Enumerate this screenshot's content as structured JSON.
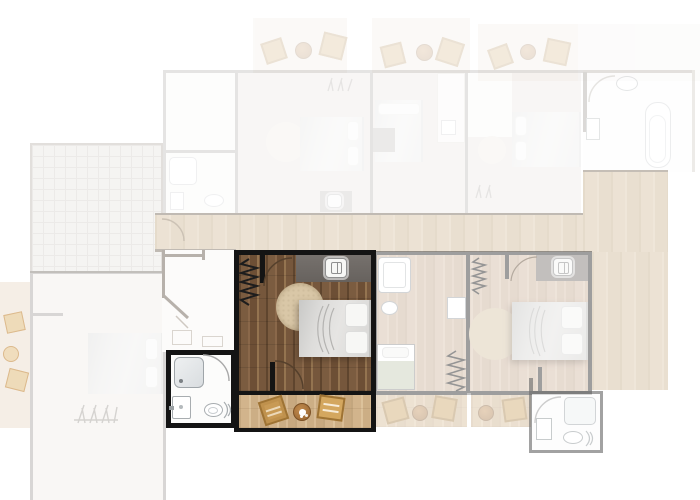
{
  "app": {
    "name": "apartment floor plan – unit selector",
    "visible_text": []
  },
  "palette": {
    "background": "#ffffff",
    "highlight_wall": "#141414",
    "bedroom_floor": "#7b5c40",
    "terrace_floor": "#d2b48c",
    "wardrobe_band": "#6f6a66",
    "rug": "#d9c7a7",
    "bed": "#dedddb",
    "corridor_floor": "#e9dfd2",
    "faded_wall": "#6b655f",
    "neighbor_wall": "#3f3f3f",
    "badge_background": "#f7f7f5",
    "chair_wood": "#c89a55"
  },
  "selected_unit": {
    "state": "highlighted",
    "rooms": [
      {
        "name": "bedroom",
        "furniture": [
          "wardrobe-band",
          "unit-badge",
          "double-bed",
          "two-pillows",
          "round-rug",
          "radiator",
          "door-arc-top",
          "door-arc-bottom"
        ]
      },
      {
        "name": "bathroom",
        "furniture": [
          "shower-tray",
          "washbasin",
          "toilet",
          "door-arc"
        ]
      },
      {
        "name": "terrace",
        "furniture": [
          "wooden-chair",
          "round-bistro-table",
          "wooden-side-table"
        ]
      },
      {
        "name": "entry-hall",
        "furniture": [
          "diagonal-wall",
          "door-leaf"
        ]
      }
    ]
  },
  "other_units": [
    {
      "name": "unit-upper-left",
      "state": "faded",
      "rooms": [
        "balcony",
        "bedroom",
        "bathroom",
        "entry-hall"
      ]
    },
    {
      "name": "unit-upper-middle",
      "state": "faded",
      "rooms": [
        "balcony",
        "bedroom",
        "closet"
      ]
    },
    {
      "name": "unit-upper-right",
      "state": "faded",
      "rooms": [
        "balcony",
        "bedroom",
        "bathroom"
      ]
    },
    {
      "name": "bathroom-upper-far-right",
      "state": "faded",
      "rooms": [
        "bathtub",
        "toilet",
        "washbasin"
      ]
    },
    {
      "name": "unit-lower-left",
      "state": "faded",
      "rooms": [
        "bedroom",
        "garden-grid",
        "side-terrace"
      ]
    },
    {
      "name": "unit-lower-right",
      "state": "faded",
      "rooms": [
        "shower-room",
        "single-bed-room",
        "bedroom",
        "terrace"
      ]
    },
    {
      "name": "bathroom-lower-right",
      "state": "faded",
      "rooms": [
        "shower-tray",
        "washbasin",
        "toilet"
      ]
    }
  ],
  "shared_areas": {
    "corridor": "wood-floor",
    "right_walkway": "wood-floor"
  },
  "icons": {
    "unit_badge": "wardrobe-badge-icon"
  }
}
